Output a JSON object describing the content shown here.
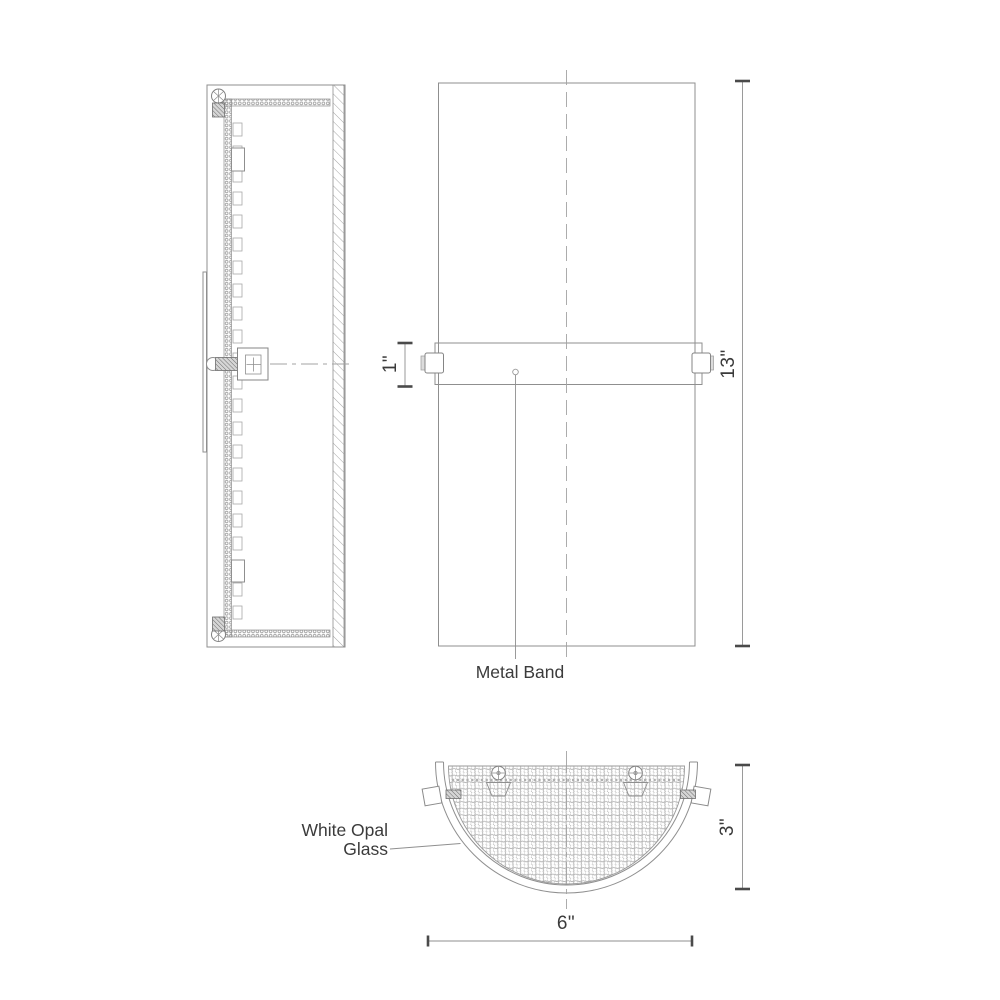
{
  "drawing": {
    "type": "technical line drawing - wall sconce, 3 orthographic views",
    "labels": {
      "metal_band": "Metal Band",
      "white_opal_line1": "White Opal",
      "white_opal_line2": "Glass"
    },
    "dims": {
      "band_height": "1\"",
      "fixture_height": "13\"",
      "depth": "3\"",
      "width": "6\""
    },
    "colors": {
      "background": "#ffffff",
      "line": "#8f8f8f",
      "centerline": "#a3a3a3",
      "tick": "#4a4a4a",
      "text": "#3b3b3b",
      "glass_pattern": "#b0b0b0"
    }
  }
}
